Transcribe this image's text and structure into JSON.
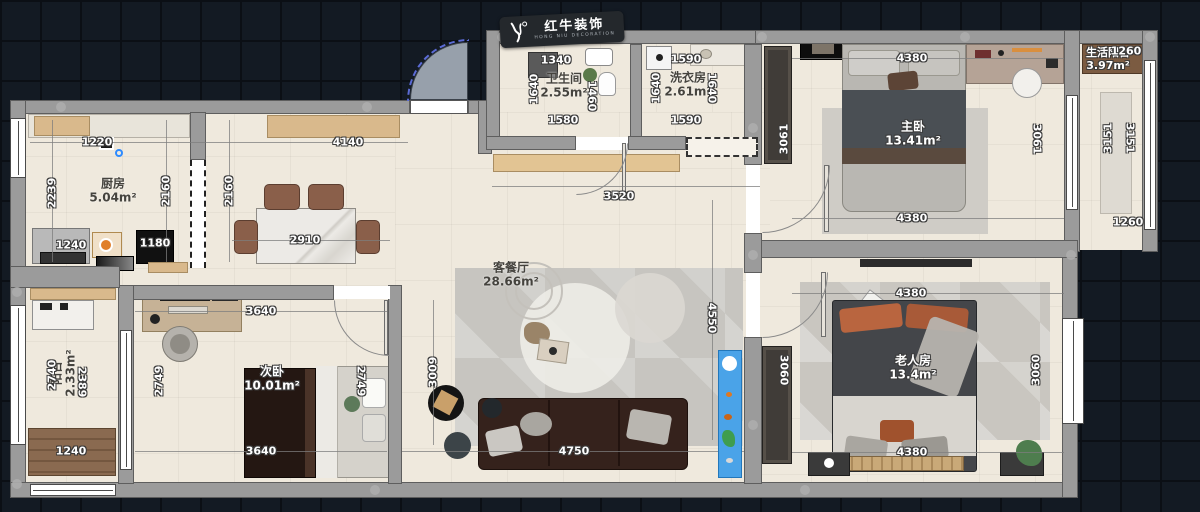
{
  "logo": {
    "brand": "红牛装饰",
    "tagline": "HONG NIU DECORATION"
  },
  "rooms": {
    "kitchen": {
      "name": "厨房",
      "area": "5.04m²"
    },
    "bathroom": {
      "name": "卫生间",
      "area": "2.55m²"
    },
    "laundry": {
      "name": "洗衣房",
      "area": "2.61m²"
    },
    "living_dining": {
      "name": "客餐厅",
      "area": "28.66m²"
    },
    "master_bedroom": {
      "name": "主卧",
      "area": "13.41m²"
    },
    "living_balcony": {
      "name": "生活阳台",
      "area": "3.97m²"
    },
    "elder_room": {
      "name": "老人房",
      "area": "13.4m²"
    },
    "second_bedroom": {
      "name": "次卧",
      "area": "10.01m²"
    },
    "balcony": {
      "name": "阳台",
      "area": "2.33m²"
    }
  },
  "dims": {
    "kitchen_top": "1220",
    "kitchen_left": "2239",
    "kitchen_right": "2160",
    "kitchen_bottom_a": "1240",
    "kitchen_bottom_b": "1180",
    "dining_top": "4140",
    "dining_left": "2160",
    "dining_table": "2910",
    "bath_top": "1340",
    "bath_left": "1640",
    "bath_right": "1460",
    "bath_bottom": "1580",
    "laundry_top": "1590",
    "laundry_left": "1640",
    "laundry_right": "1640",
    "laundry_bottom": "1590",
    "hall_top": "3520",
    "living_left": "3009",
    "living_right": "4550",
    "living_sofa": "4750",
    "master_top": "4380",
    "master_left": "3061",
    "master_right": "3061",
    "master_bottom": "4380",
    "lbalcony_top": "1260",
    "lbalcony_left": "3151",
    "lbalcony_right": "3151",
    "lbalcony_bottom": "1260",
    "elder_top": "4380",
    "elder_left": "3060",
    "elder_right": "3060",
    "elder_bottom": "4380",
    "second_top": "3640",
    "second_left": "2749",
    "second_right": "2749",
    "second_bottom": "3640",
    "balcony_v1": "2740",
    "balcony_v2": "2389",
    "balcony_bottom": "1240"
  }
}
